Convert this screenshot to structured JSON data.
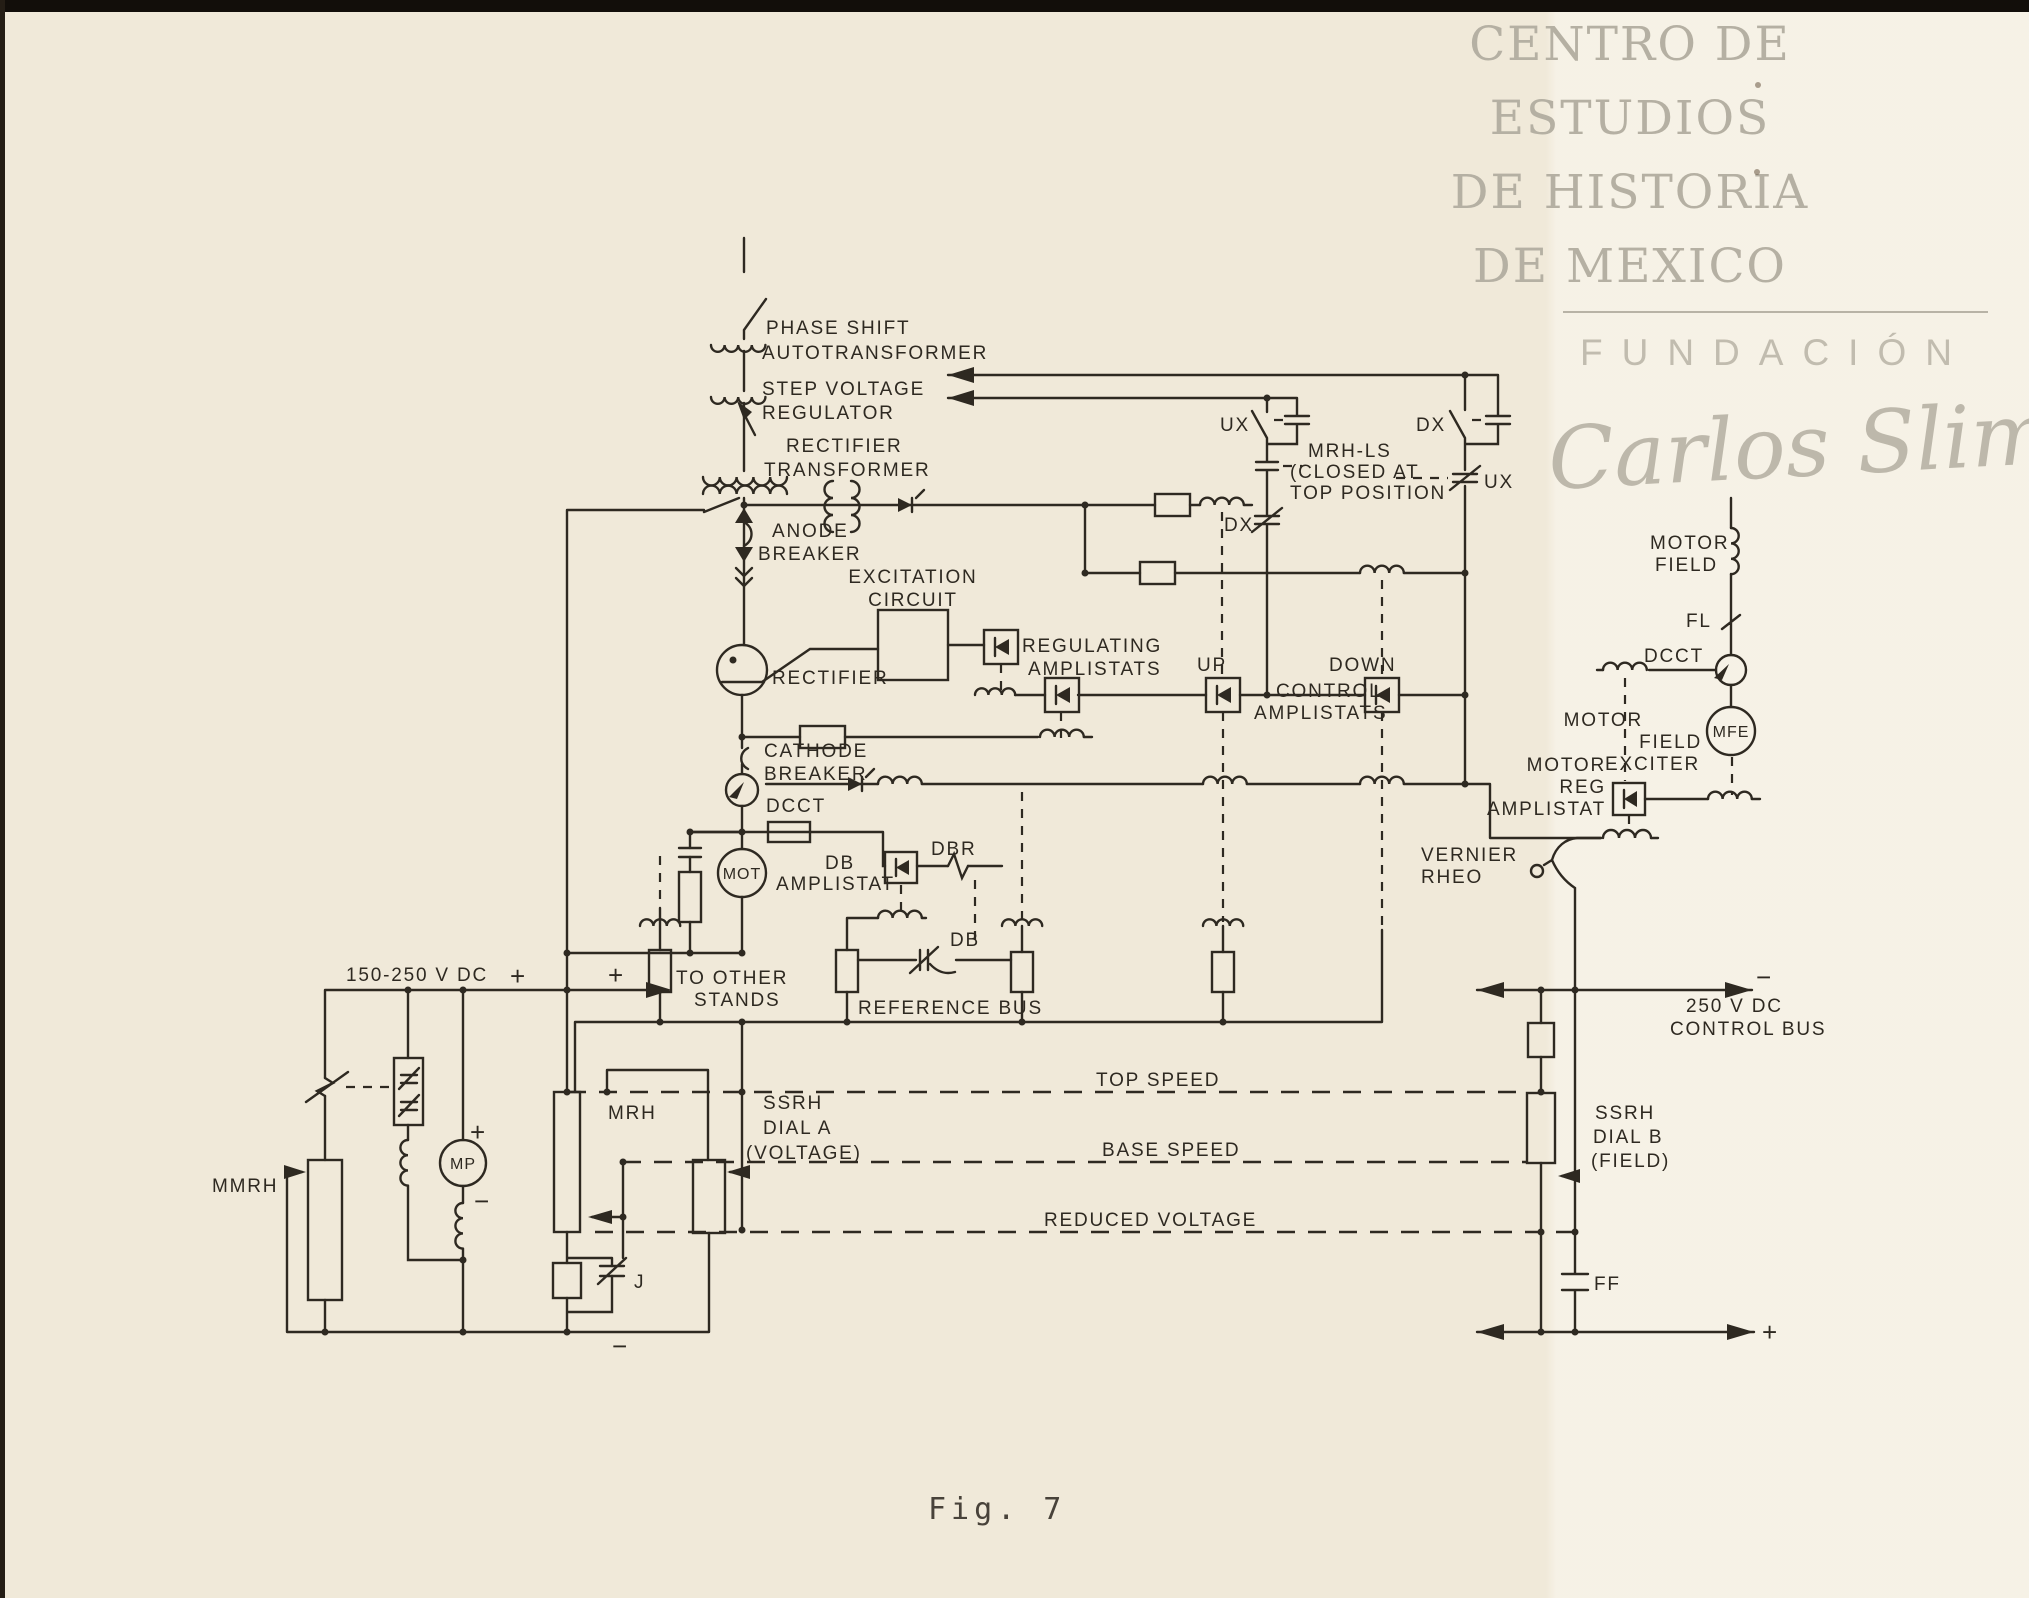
{
  "page": {
    "figure_caption": "Fig. 7"
  },
  "colors": {
    "paper": "#f0e9d9",
    "ink": "#2e2921",
    "watermark_gray": "#b5b0a3"
  },
  "watermark": {
    "lines": [
      "CENTRO DE",
      "ESTUDIOS",
      "DE HISTORIA",
      "DE MEXICO"
    ],
    "foundation": "FUNDACIÓN",
    "signature": "Carlos Slim"
  },
  "diagram": {
    "labels": {
      "phase_shift_1": "PHASE SHIFT",
      "phase_shift_2": "AUTOTRANSFORMER",
      "step_voltage_1": "STEP VOLTAGE",
      "step_voltage_2": "REGULATOR",
      "rectifier_transformer_1": "RECTIFIER",
      "rectifier_transformer_2": "TRANSFORMER",
      "anode_breaker_1": "ANODE",
      "anode_breaker_2": "BREAKER",
      "excitation_1": "EXCITATION",
      "excitation_2": "CIRCUIT",
      "rectifier": "RECTIFIER",
      "regulating_amplistats_1": "REGULATING",
      "regulating_amplistats_2": "AMPLISTATS",
      "cathode_breaker_1": "CATHODE",
      "cathode_breaker_2": "BREAKER",
      "dcct_left": "DCCT",
      "mot": "MOT",
      "db_amplistat_1": "DB",
      "db_amplistat_2": "AMPLISTAT",
      "dbr": "DBR",
      "db_contact": "DB",
      "ux_left": "UX",
      "dx_left": "DX",
      "mrh_ls_1": "MRH-LS",
      "mrh_ls_2": "(CLOSED AT",
      "mrh_ls_3": "TOP POSITION",
      "dx_right": "DX",
      "ux_right": "UX",
      "up": "UP",
      "down": "DOWN",
      "control_amplistats_1": "CONTROL",
      "control_amplistats_2": "AMPLISTATS",
      "motor_field_1": "MOTOR",
      "motor_field_2": "FIELD",
      "fl": "FL",
      "dcct_right": "DCCT",
      "mfe": "MFE",
      "motor_field_exciter_1": "MOTOR",
      "motor_field_exciter_2": "FIELD",
      "motor_field_exciter_3": "EXCITER",
      "motor_reg_amplistat_1": "MOTOR",
      "motor_reg_amplistat_2": "REG",
      "motor_reg_amplistat_3": "AMPLISTAT",
      "vernier_rheo_1": "VERNIER",
      "vernier_rheo_2": "RHEO",
      "dc_bus_label": "150-250 V DC",
      "dc_bus_plus": "+",
      "stands_plus": "+",
      "to_other_stands_1": "TO OTHER",
      "to_other_stands_2": "STANDS",
      "reference_bus": "REFERENCE BUS",
      "top_speed": "TOP SPEED",
      "base_speed": "BASE SPEED",
      "reduced_voltage": "REDUCED VOLTAGE",
      "mmrh": "MMRH",
      "mp": "MP",
      "mp_plus": "+",
      "mp_minus": "−",
      "mrh": "MRH",
      "j": "J",
      "ssrh_a_1": "SSRH",
      "ssrh_a_2": "DIAL A",
      "ssrh_a_3": "(VOLTAGE)",
      "ssrh_b_1": "SSRH",
      "ssrh_b_2": "DIAL B",
      "ssrh_b_3": "(FIELD)",
      "ff": "FF",
      "control_bus_1": "250 V DC",
      "control_bus_2": "CONTROL BUS",
      "control_bus_minus": "−",
      "bottom_plus": "+",
      "bottom_minus": "−"
    }
  }
}
